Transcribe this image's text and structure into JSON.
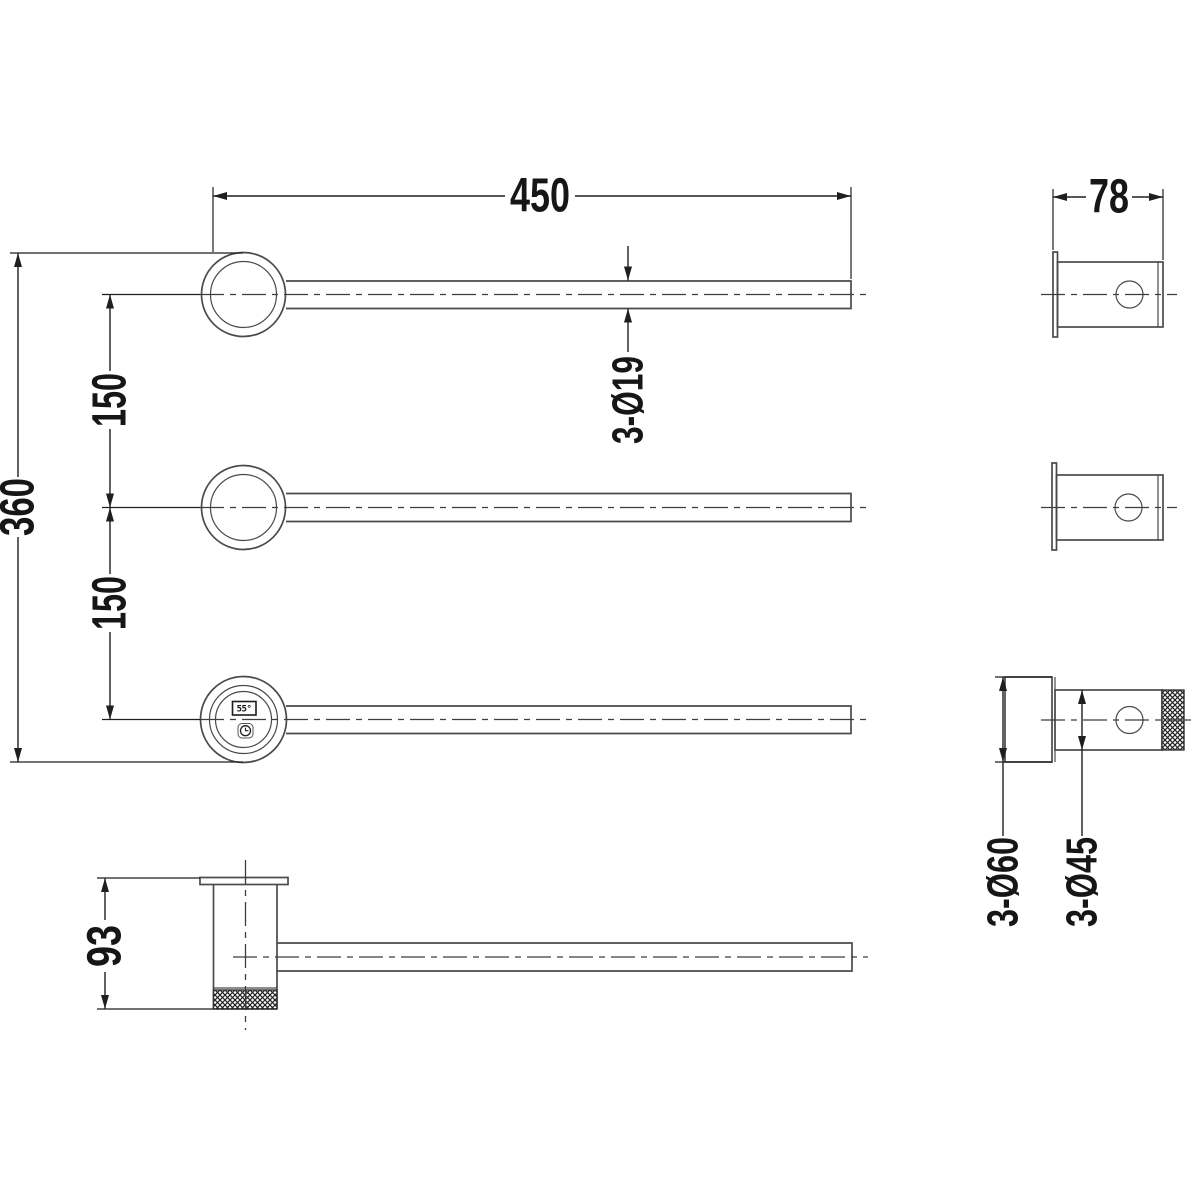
{
  "drawing": {
    "kind": "technical-dimension-drawing",
    "subject": "three-bar swivel heated towel rail with temperature display",
    "background_color": "#ffffff",
    "part_line_color": "#4a4a4a",
    "dimension_line_color": "#1f1f1f",
    "dims": {
      "bar_length": "450",
      "bracket_depth": "78",
      "spacing_upper": "150",
      "spacing_lower": "150",
      "overall_height": "360",
      "bar_diameter": "3-Ø19",
      "flange_diameter": "3-Ø60",
      "body_diameter": "3-Ø45",
      "bracket_height": "93"
    },
    "control_panel": {
      "temperature_display": "55°",
      "button_icon": "timer-clock"
    }
  }
}
